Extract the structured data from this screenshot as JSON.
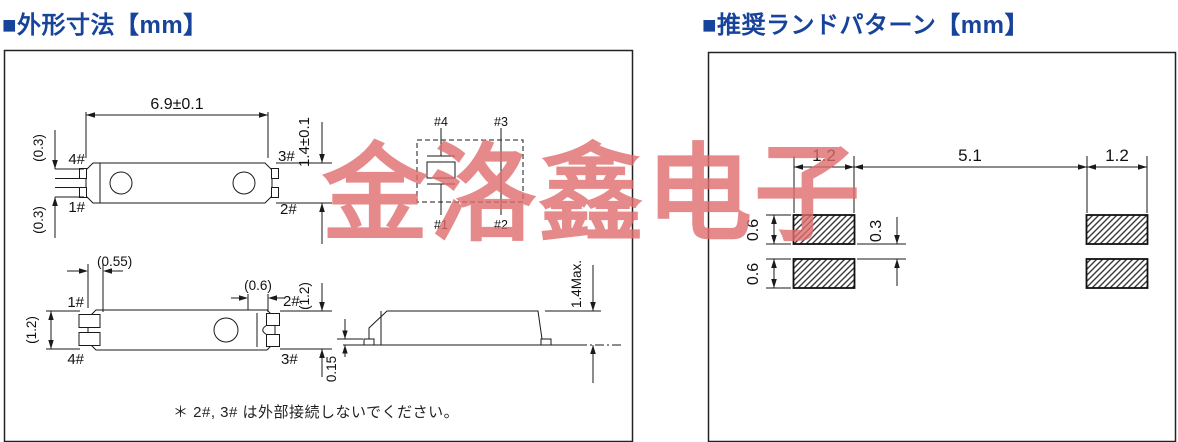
{
  "watermark": {
    "text": "金洛鑫电子"
  },
  "colors": {
    "title_blue": "#17439b",
    "watermark_red": "#df6c6d",
    "line": "#1a1a1a"
  },
  "left_panel": {
    "title": "■外形寸法【mm】",
    "top_view": {
      "dim_width": "6.9±0.1",
      "dim_height": "1.4±0.1",
      "dim_lead_top": "(0.3)",
      "dim_lead_bottom": "(0.3)",
      "pin_top_left": "4#",
      "pin_top_right": "3#",
      "pin_bottom_left": "1#",
      "pin_bottom_right": "2#"
    },
    "schematic": {
      "pin_top_left": "#4",
      "pin_top_right": "#3",
      "pin_bottom_left": "#1",
      "pin_bottom_right": "#2"
    },
    "bottom_view": {
      "dim_edge": "(0.55)",
      "dim_castellation": "(0.6)",
      "dim_height_left": "(1.2)",
      "dim_height_right": "(1.2)",
      "pin_top_left": "1#",
      "pin_top_right": "2#",
      "pin_bottom_left": "4#",
      "pin_bottom_right": "3#"
    },
    "side_view": {
      "dim_height": "1.4Max.",
      "dim_standoff": "0.15"
    },
    "note": "＊ 2#, 3# は外部接続しないでください。"
  },
  "right_panel": {
    "title": "■推奨ランドパターン【mm】",
    "dims": {
      "pad_width_left": "1.2",
      "pitch": "5.1",
      "pad_width_right": "1.2",
      "pad_height_top": "0.6",
      "pad_height_bottom": "0.6",
      "pad_gap": "0.3"
    }
  }
}
